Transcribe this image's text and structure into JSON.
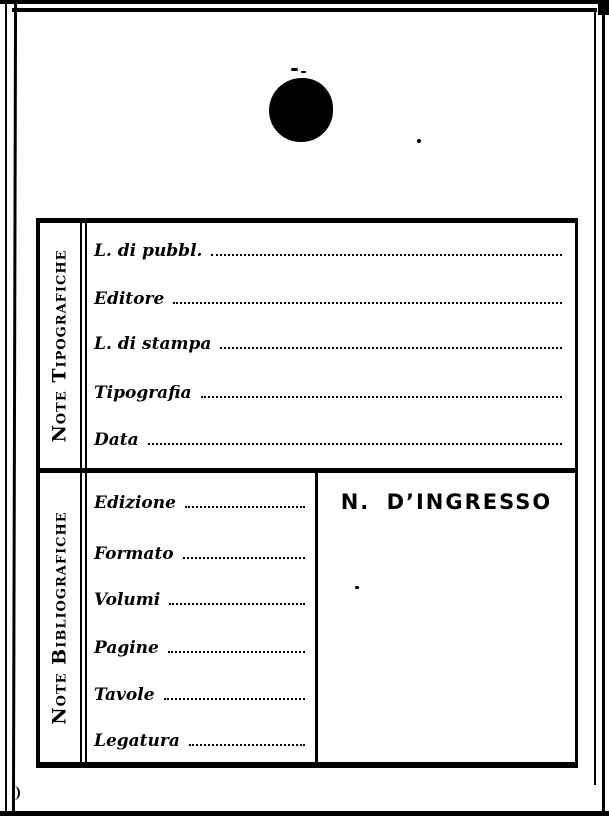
{
  "page": {
    "paper_color": "#ffffff",
    "ink_color": "#000000"
  },
  "card": {
    "sections": [
      {
        "title": "Note Tipografiche",
        "fields": [
          {
            "label": "L. di pubbl.",
            "value": ""
          },
          {
            "label": "Editore",
            "value": ""
          },
          {
            "label": "L. di stampa",
            "value": ""
          },
          {
            "label": "Tipografia",
            "value": ""
          },
          {
            "label": "Data",
            "value": ""
          }
        ]
      },
      {
        "title": "Note Bibliografiche",
        "fields": [
          {
            "label": "Edizione",
            "value": ""
          },
          {
            "label": "Formato",
            "value": ""
          },
          {
            "label": "Volumi",
            "value": ""
          },
          {
            "label": "Pagine",
            "value": ""
          },
          {
            "label": "Tavole",
            "value": ""
          },
          {
            "label": "Legatura",
            "value": ""
          }
        ],
        "ingresso": {
          "label": "N. D’INGRESSO",
          "value": ""
        }
      }
    ]
  }
}
